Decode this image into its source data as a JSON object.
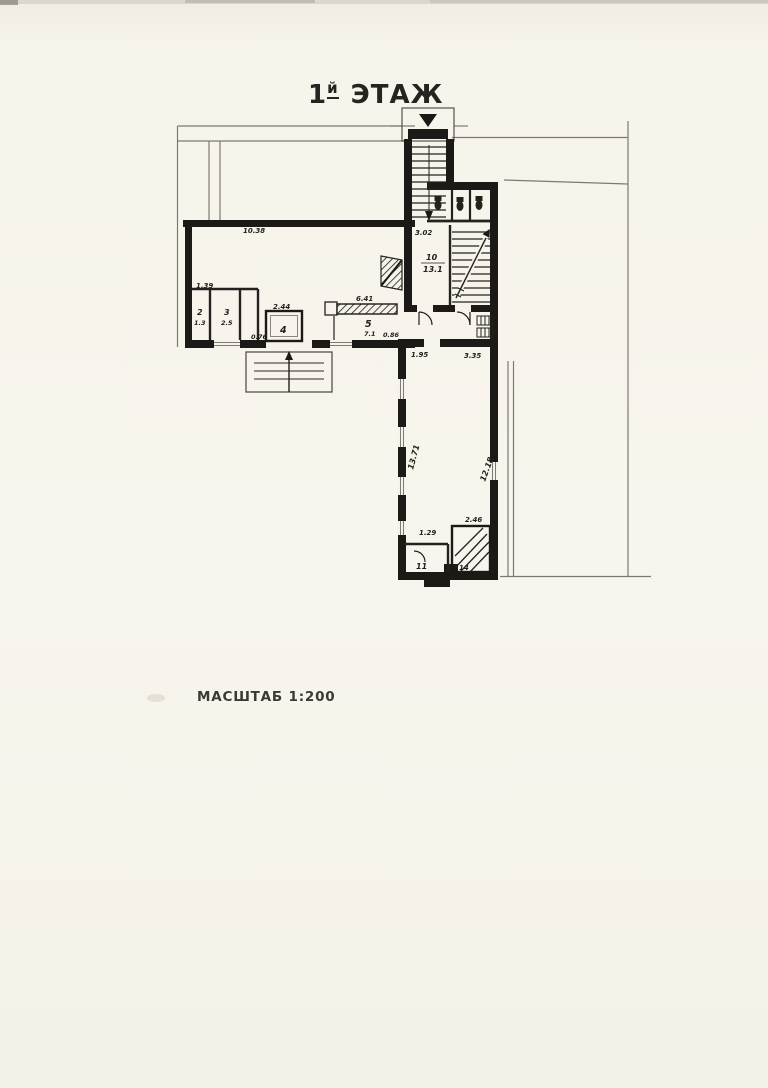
{
  "page": {
    "paper_color": "#f6f3ea",
    "ink_color": "#1c1a16",
    "faint_line_color": "#7d7a72"
  },
  "header": {
    "title_prefix": "1",
    "title_sup": "й",
    "title_word": "ЭТАЖ"
  },
  "footer": {
    "scale_label": "МАСШТАБ 1:200"
  },
  "plan": {
    "labels": {
      "hall_width": "10.38",
      "dim_left_top": "1.39",
      "room2_num": "2",
      "room2_area": "1.3",
      "room3_num": "3",
      "room3_area": "2.5",
      "dim_076": "0.76",
      "dim_244": "2.44",
      "room4_num": "4",
      "dim_641": "6.41",
      "room5_num": "5",
      "room5_area": "7.1",
      "dim_086": "0.86",
      "dim_302": "3.02",
      "room10_num": "10",
      "room10_area": "13.1",
      "dim_195": "1.95",
      "dim_335": "3.35",
      "wing_left_dim": "13.71",
      "wing_right_dim": "12.18",
      "dim_129": "1.29",
      "dim_246": "2.46",
      "room11_num": "11",
      "room14_num": "14"
    }
  }
}
